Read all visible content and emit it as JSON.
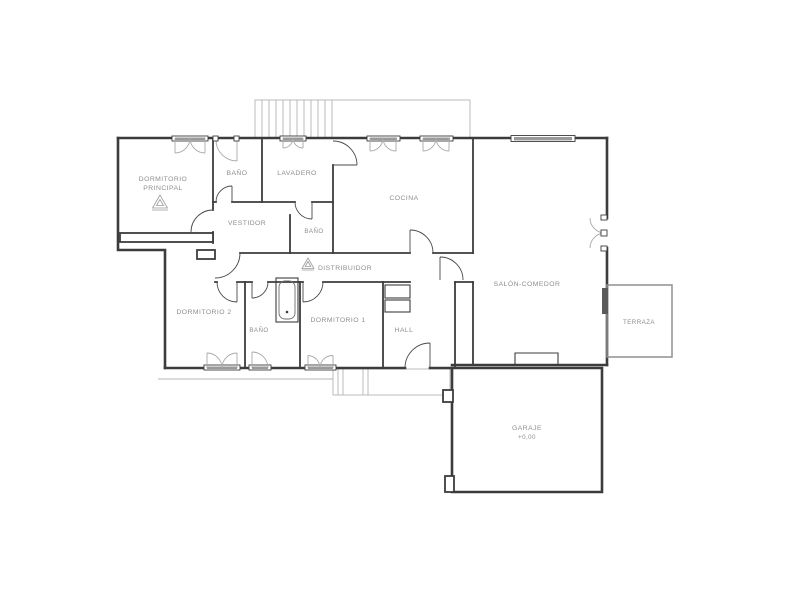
{
  "page": {
    "background": "#ffffff"
  },
  "colors": {
    "wall": "#3c3c3c",
    "window_light": "#9a9a9a",
    "label_text": "#8e8e8e"
  },
  "rooms": {
    "dormitorio_principal": {
      "line1": "DORMITORIO",
      "line2": "PRINCIPAL"
    },
    "bano_top": {
      "label": "BAÑO"
    },
    "lavadero": {
      "label": "LAVADERO"
    },
    "vestidor": {
      "label": "VESTIDOR"
    },
    "bano_mid": {
      "label": "BAÑO"
    },
    "cocina": {
      "label": "COCINA"
    },
    "distribuidor": {
      "label": "DISTRIBUIDOR"
    },
    "dormitorio_2": {
      "label": "DORMITORIO 2"
    },
    "bano_low": {
      "label": "BAÑO"
    },
    "dormitorio_1": {
      "label": "DORMITORIO 1"
    },
    "hall": {
      "label": "HALL"
    },
    "salon_comedor": {
      "label": "SALÓN-COMEDOR"
    },
    "terraza": {
      "label": "TERRAZA"
    },
    "garaje": {
      "label": "GARAJE",
      "level": "+0,00"
    }
  }
}
